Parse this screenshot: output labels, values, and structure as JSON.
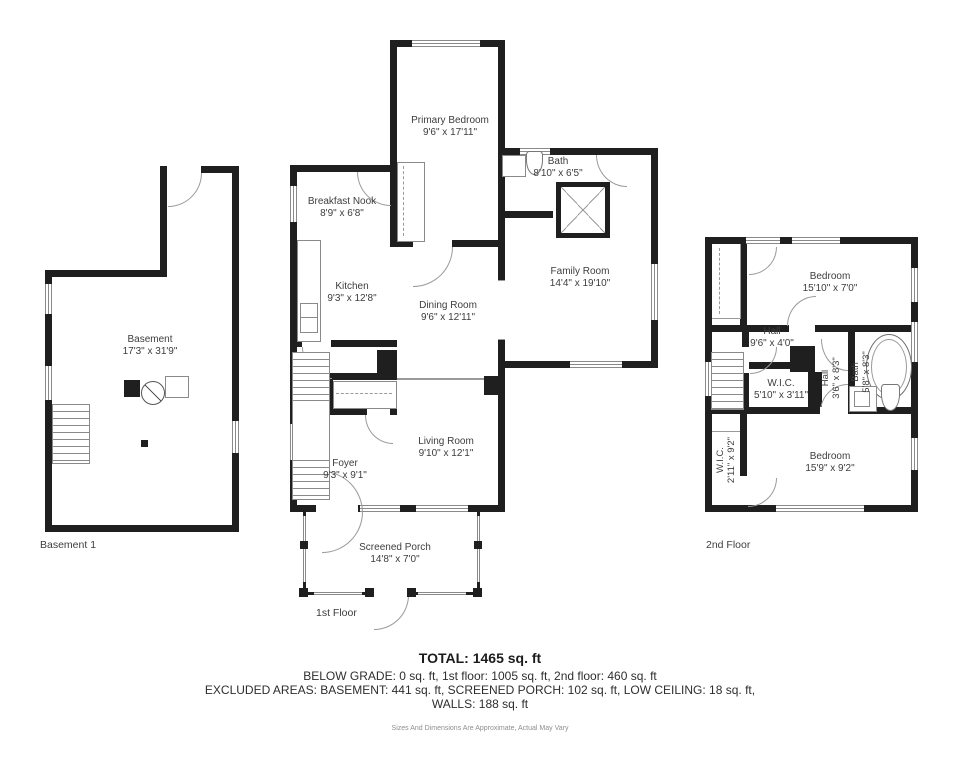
{
  "floors": {
    "basement": {
      "label": "Basement 1",
      "rooms": [
        {
          "name": "Basement",
          "dims": "17'3\" x 31'9\""
        }
      ]
    },
    "first": {
      "label": "1st Floor",
      "rooms": [
        {
          "name": "Primary Bedroom",
          "dims": "9'6\" x 17'11\""
        },
        {
          "name": "Breakfast Nook",
          "dims": "8'9\" x 6'8\""
        },
        {
          "name": "Kitchen",
          "dims": "9'3\" x 12'8\""
        },
        {
          "name": "Dining Room",
          "dims": "9'6\" x 12'11\""
        },
        {
          "name": "Bath",
          "dims": "8'10\" x 6'5\""
        },
        {
          "name": "Family Room",
          "dims": "14'4\" x 19'10\""
        },
        {
          "name": "Living Room",
          "dims": "9'10\" x 12'1\""
        },
        {
          "name": "Foyer",
          "dims": "9'3\" x 9'1\""
        },
        {
          "name": "Screened Porch",
          "dims": "14'8\" x 7'0\""
        }
      ]
    },
    "second": {
      "label": "2nd Floor",
      "rooms": [
        {
          "name": "Bedroom",
          "dims": "15'10\" x 7'0\""
        },
        {
          "name": "Hall",
          "dims": "9'6\" x 4'0\""
        },
        {
          "name": "Hall",
          "dims": "3'6\" x 8'3\""
        },
        {
          "name": "Bath",
          "dims": "5'8\" x 8'3\""
        },
        {
          "name": "W.I.C.",
          "dims": "5'10\" x 3'11\""
        },
        {
          "name": "W.I.C.",
          "dims": "2'11\" x 9'2\""
        },
        {
          "name": "Bedroom",
          "dims": "15'9\" x 9'2\""
        }
      ]
    }
  },
  "summary": {
    "total": "TOTAL: 1465 sq. ft",
    "grade_line": "BELOW GRADE: 0 sq. ft, 1st floor: 1005 sq. ft, 2nd floor: 460 sq. ft",
    "excluded_line1": "EXCLUDED AREAS: BASEMENT: 441 sq. ft, SCREENED PORCH: 102 sq. ft, LOW CEILING: 18 sq. ft,",
    "excluded_line2": "WALLS: 188 sq. ft",
    "disclaimer": "Sizes And Dimensions Are Approximate, Actual May Vary"
  },
  "colors": {
    "wall": "#1f1f1f",
    "line": "#9a9a9a",
    "text": "#3d3d3d"
  }
}
